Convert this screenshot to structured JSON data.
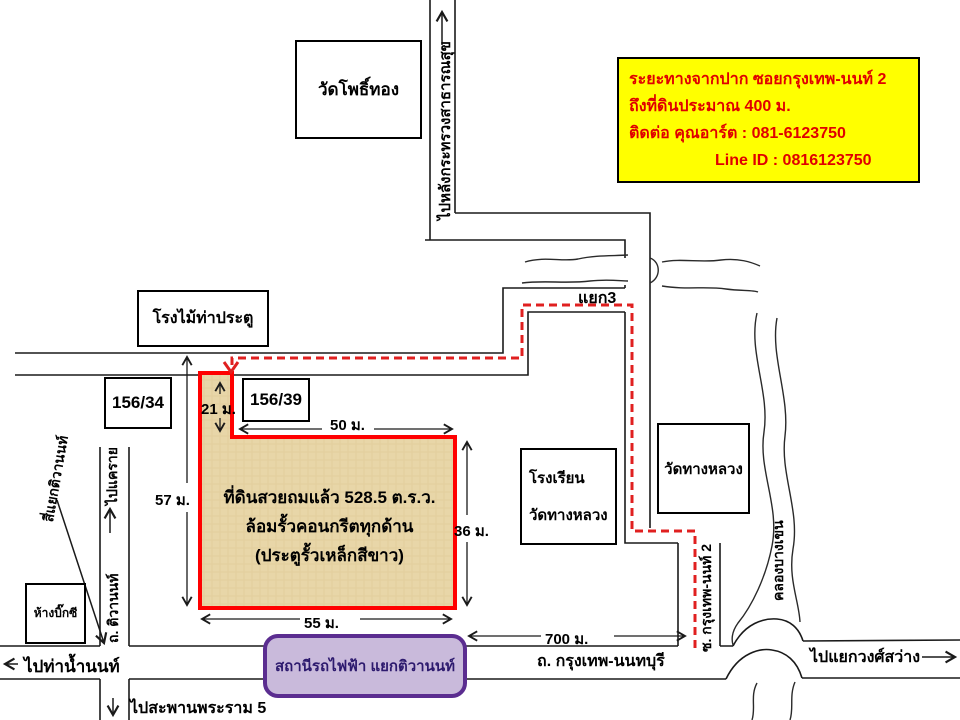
{
  "info_box": {
    "bg_color": "#FFFF00",
    "text_color": "#E00000",
    "line1": "ระยะทางจากปาก ซอยกรุงเทพ-นนท์ 2",
    "line2": "ถึงที่ดินประมาณ 400 ม.",
    "line3": "ติดต่อ คุณอาร์ต : 081-6123750",
    "line4": "Line ID : 0816123750"
  },
  "plot": {
    "line1": "ที่ดินสวยถมแล้ว 528.5 ต.ร.ว.",
    "line2": "ล้อมรั้วคอนกรีตทุกด้าน",
    "line3": "(ประตูรั้วเหล็กสีขาว)",
    "border_color": "#FF0000",
    "fill_color": "#E8D6A8"
  },
  "dimensions": {
    "neck_height": "21 ม.",
    "top_width": "50 ม.",
    "left_height": "57 ม.",
    "right_height": "36 ม.",
    "bottom_width": "55 ม.",
    "distance_to_soi": "700 ม."
  },
  "landmarks": {
    "wat_pho_thong": "วัดโพธิ์ทอง",
    "lumber_yard": "โรงไม้ท่าประตู",
    "house_156_34": "156/34",
    "house_156_39": "156/39",
    "school_line1": "โรงเรียน",
    "school_line2": "วัดทางหลวง",
    "wat_thang_luang": "วัดทางหลวง",
    "big_c": "ห้างบิ๊กซี"
  },
  "station": {
    "label": "สถานีรถไฟฟ้า แยกติวานนท์",
    "border_color": "#5B2D90",
    "fill_color": "#C9BADB",
    "text_color": "#2D1A6E"
  },
  "roads": {
    "bangkok_nonthaburi": "ถ. กรุงเทพ-นนทบุรี",
    "tiwanon": "ถ. ติวานนท์",
    "soi_krungthep_non_2": "ซ. กรุงเทพ-นนท์ 2",
    "khlong_bang_khen": "คลองบางเขน",
    "junction3": "แยก3",
    "tiwanon_intersection": "สี่แยกติวานนท์"
  },
  "directions": {
    "to_ministry": "ไปหลังกระทรวงสาธารณสุข",
    "to_khae_rai": "ไปแคราย",
    "to_tha_nam_non": "ไปท่าน้ำนนท์",
    "to_rama5": "ไปสะพานพระราม 5",
    "to_wong_sawang": "ไปแยกวงศ์สว่าง"
  },
  "route_color": "#E02020"
}
